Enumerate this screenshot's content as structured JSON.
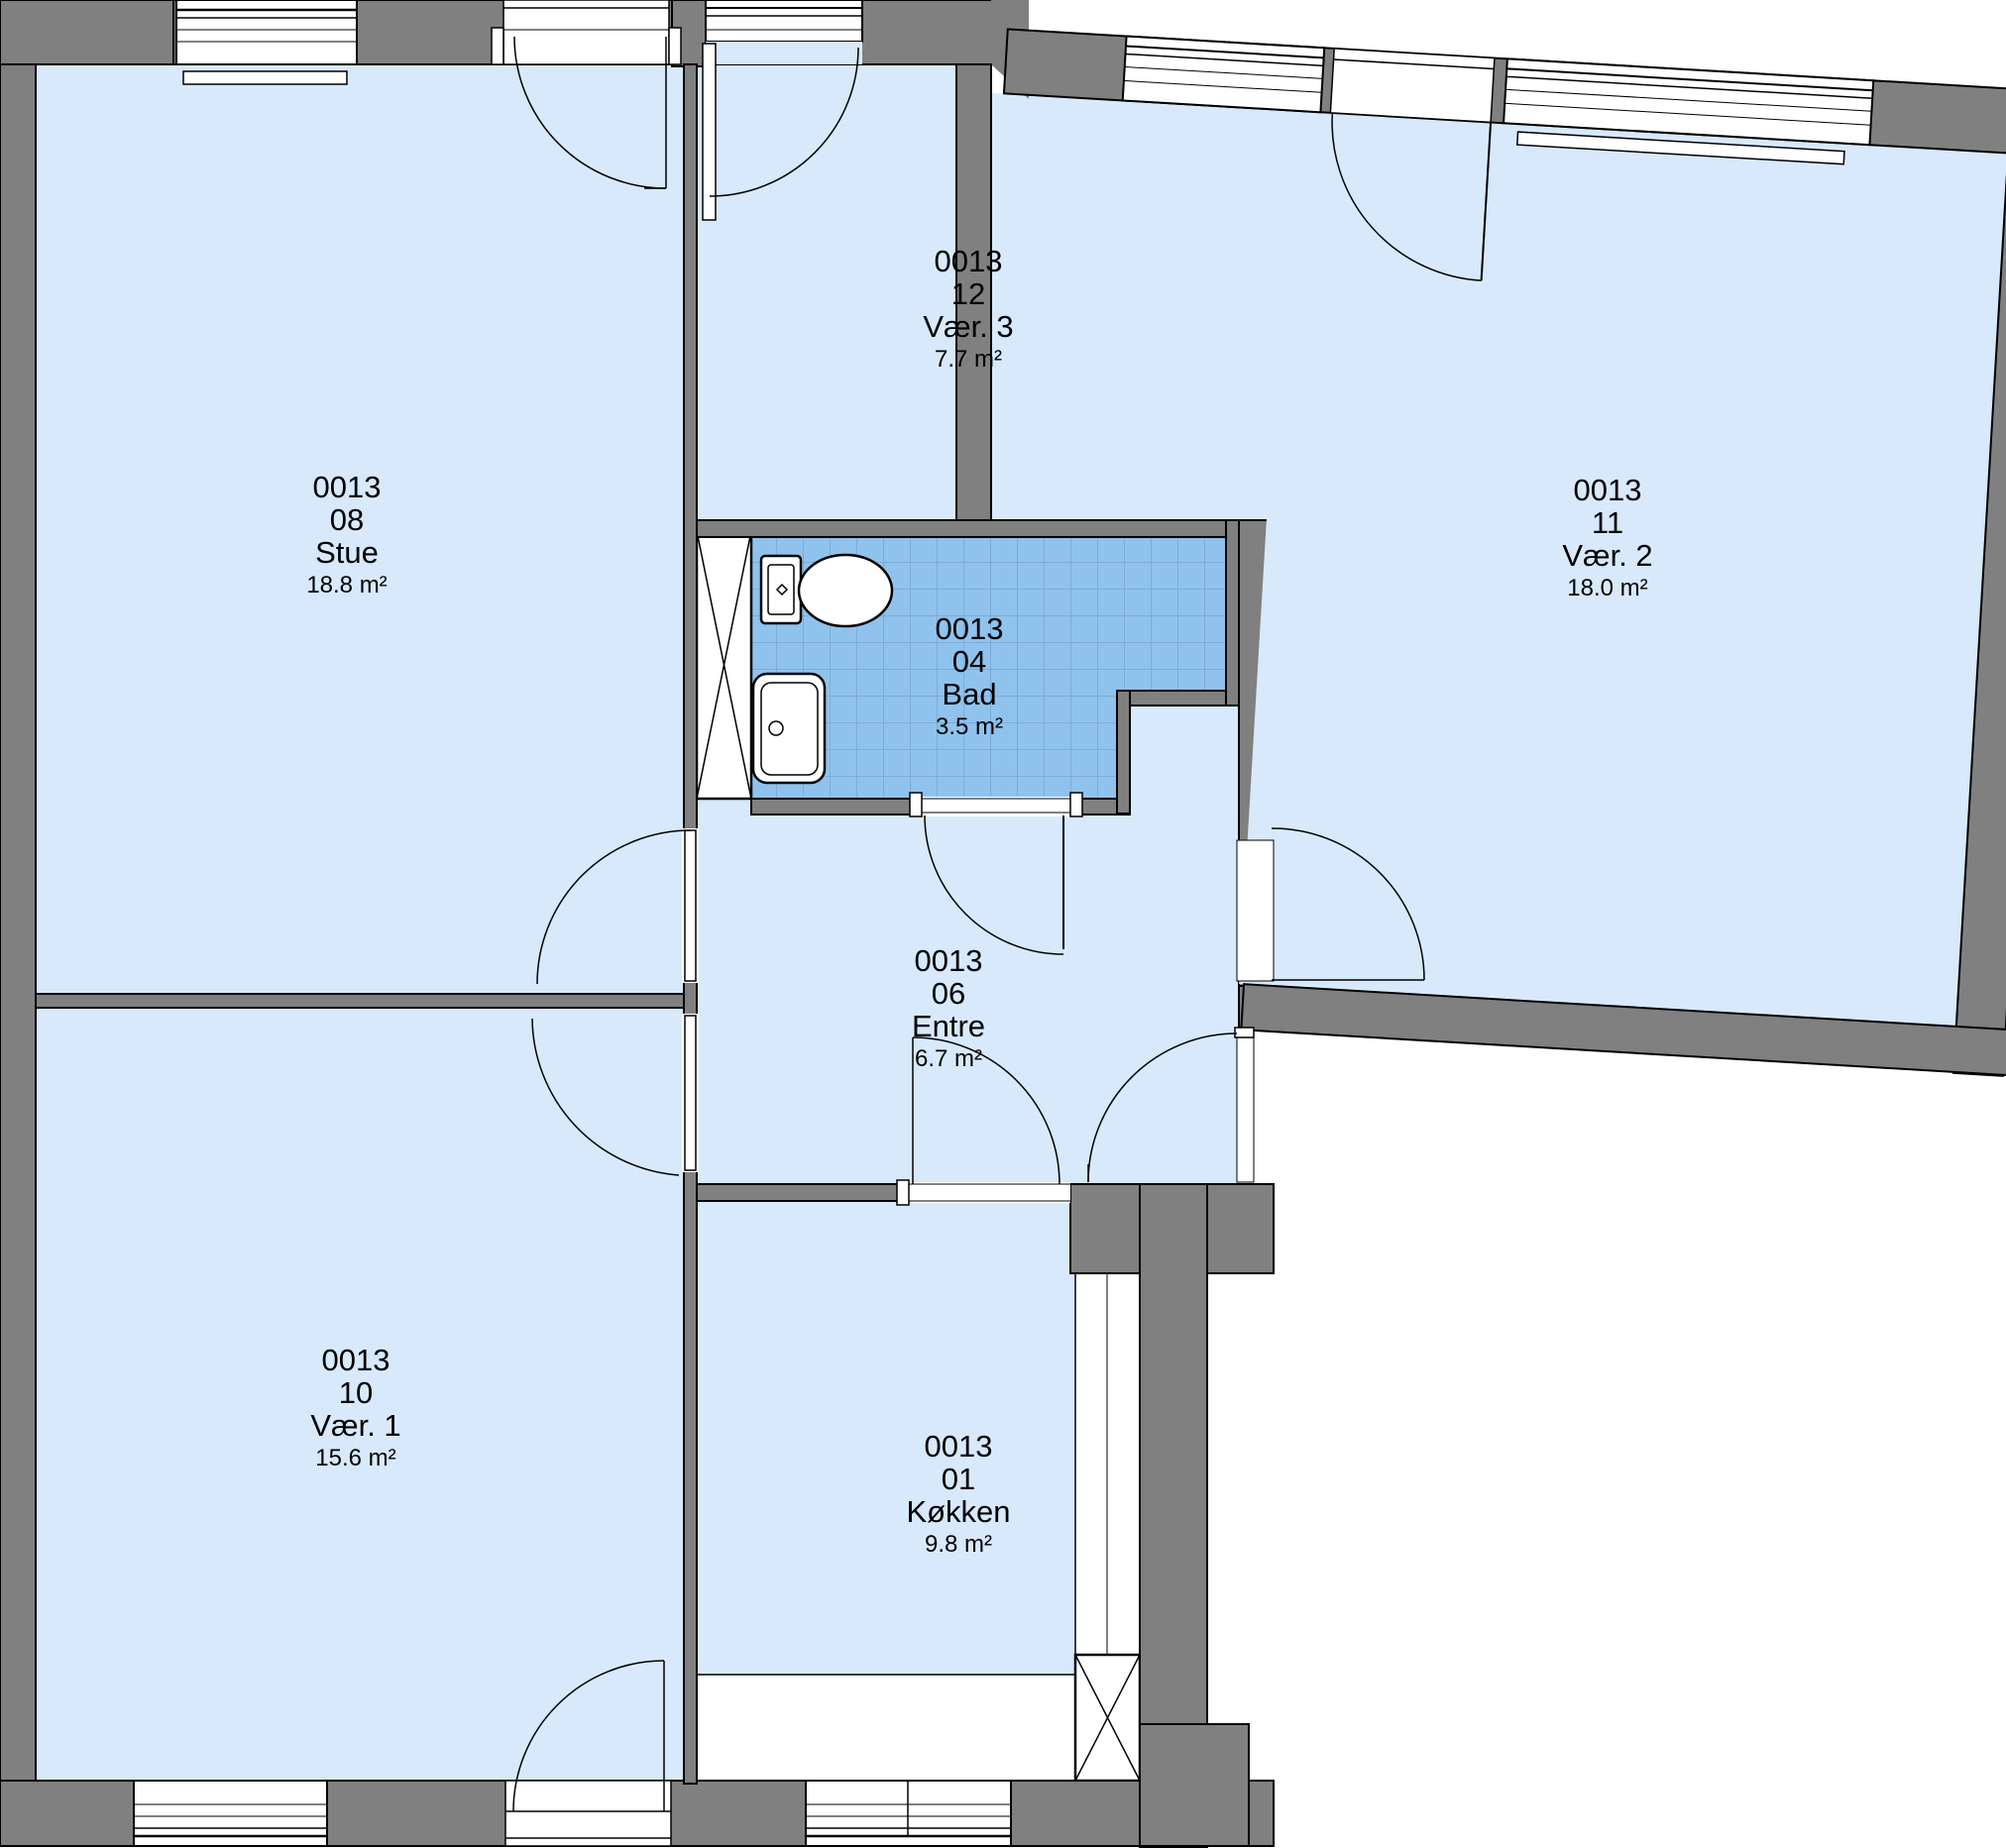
{
  "plan": {
    "type": "apartment-floor-plan",
    "unit_id": "0013",
    "colors": {
      "wall": "#808080",
      "room_fill": "#d8e9fc",
      "bath_tile": "#8fc3ee",
      "bath_grid": "#79a5cf",
      "outline": "#000000",
      "background": "#ffffff"
    },
    "rooms": [
      {
        "id": "stue",
        "unit": "0013",
        "number": "08",
        "name": "Stue",
        "area": "18.8 m²"
      },
      {
        "id": "vaer3",
        "unit": "0013",
        "number": "12",
        "name": "Vær. 3",
        "area": "7.7 m²"
      },
      {
        "id": "vaer2",
        "unit": "0013",
        "number": "11",
        "name": "Vær. 2",
        "area": "18.0 m²"
      },
      {
        "id": "bad",
        "unit": "0013",
        "number": "04",
        "name": "Bad",
        "area": "3.5 m²"
      },
      {
        "id": "entre",
        "unit": "0013",
        "number": "06",
        "name": "Entre",
        "area": "6.7 m²"
      },
      {
        "id": "vaer1",
        "unit": "0013",
        "number": "10",
        "name": "Vær. 1",
        "area": "15.6 m²"
      },
      {
        "id": "koekken",
        "unit": "0013",
        "number": "01",
        "name": "Køkken",
        "area": "9.8 m²"
      }
    ],
    "fixtures": [
      "toilet",
      "sink",
      "bathtub-none",
      "duct-shaft",
      "duct-shaft",
      "radiator",
      "radiator",
      "kitchen-counter"
    ]
  }
}
